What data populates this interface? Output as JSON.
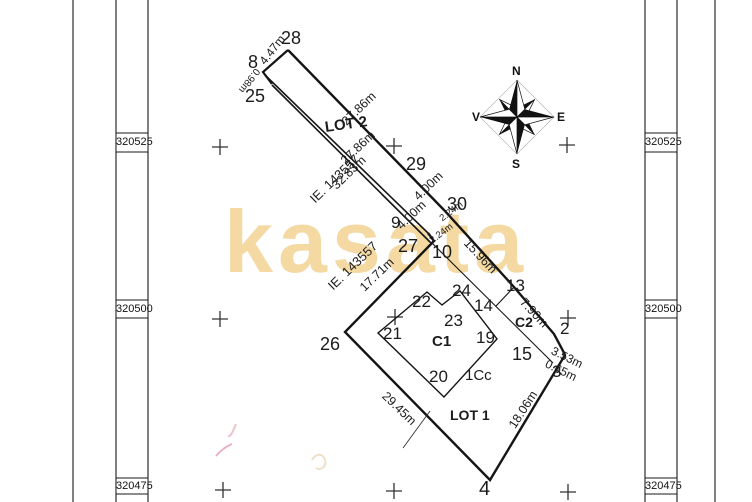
{
  "plan": {
    "watermark": "kasata",
    "compass": {
      "north": "N",
      "south": "S",
      "east": "E",
      "west": "V"
    },
    "grid": {
      "row1": "320525",
      "row2": "320500",
      "row3": "320475"
    },
    "labels": {
      "p28": "28",
      "p8": "8",
      "p25": "25",
      "p29": "29",
      "p30": "30",
      "p9": "9",
      "p27": "27",
      "p10": "10",
      "p13": "13",
      "p24": "24",
      "p22": "22",
      "p14": "14",
      "p23": "23",
      "p2": "2",
      "p21": "21",
      "p19": "19",
      "p26": "26",
      "p15": "15",
      "p3": "3",
      "p20": "20",
      "p4": "4",
      "lot2": "LOT 2",
      "lot1": "LOT 1",
      "c1": "C1",
      "c2": "C2",
      "cc": "1Cc",
      "ie1": "IE. 143557",
      "ie2": "IE. 143557",
      "m_447": "4.47m",
      "m_098": "0.98m",
      "m_2786a": "27.86m",
      "m_2786b": "27.86m",
      "m_3283": "32.83m",
      "m_400a": "4.00m",
      "m_400b": "4.00m",
      "m_224a": "2.24m",
      "m_224b": "2.24m",
      "m_1596": "15.96m",
      "m_790": "7.90m",
      "m_353": "3.53m",
      "m_065": "0.65m",
      "m_1806": "18.06m",
      "m_2945": "29.45m",
      "m_1771": "17.71m"
    }
  }
}
